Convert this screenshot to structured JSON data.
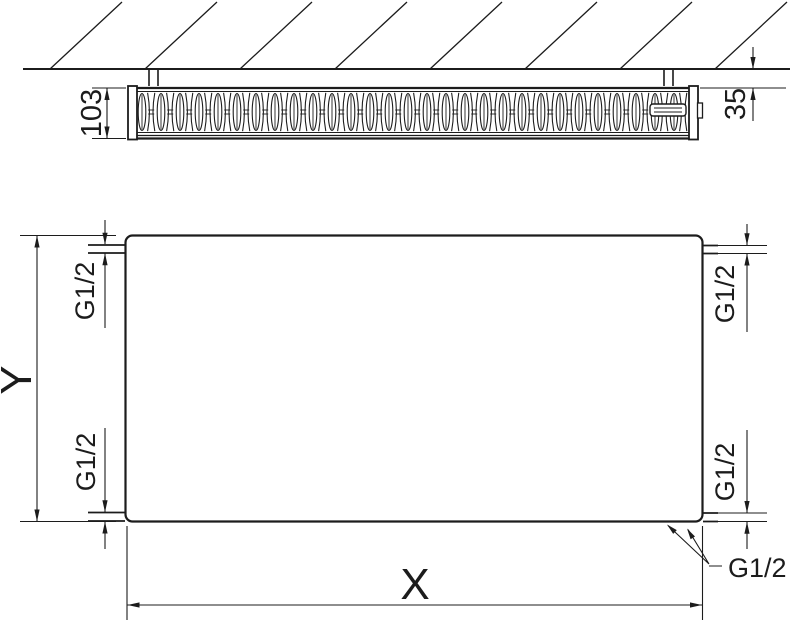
{
  "drawing": {
    "background": "#ffffff",
    "line_color": "#1c1c1c"
  },
  "top_view": {
    "depth_dimension": "103",
    "wall_gap_dimension": "35"
  },
  "front_view": {
    "height_dimension": "Y",
    "width_dimension": "X",
    "thread_top_left": "G1/2",
    "thread_bottom_left": "G1/2",
    "thread_top_right": "G1/2",
    "thread_bottom_right": "G1/2",
    "thread_leader": "G1/2"
  }
}
